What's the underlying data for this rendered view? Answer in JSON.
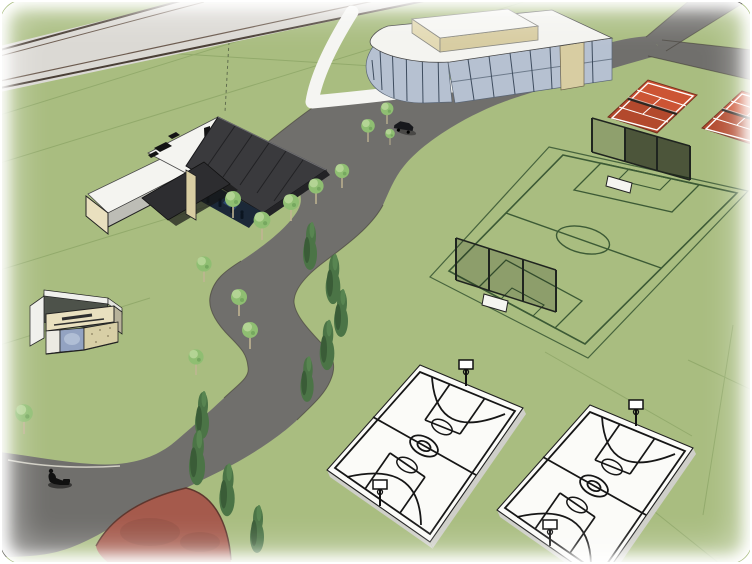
{
  "scene": {
    "title": "Aerial 3D rendering of a sports park master plan",
    "style": "SketchUp-style architectural render, oblique aerial view",
    "ground": "green lawn with faint parcel lines"
  },
  "colors": {
    "grass": "#a9bd80",
    "parcel": "#7d9858",
    "road": "#706f6c",
    "road_edge": "#45413b",
    "road_light": "#dbd9d4",
    "road_light_stripe": "#4a3f36",
    "road_light_stripe2": "#6b5a4e",
    "sidewalk": "#f5f5f2",
    "track_red": "#a55a4c",
    "track_edge": "#5e372e",
    "tennis_red": "#cc5434",
    "tennis_edge": "#7a3322",
    "net_dark": "#2e2620",
    "field_line": "#3c5a35",
    "fence": "#1f241f",
    "slab": "#fbfbf8",
    "slab_side": "#cfcfc9",
    "court_line": "#161616",
    "roof_white": "#f4f4f0",
    "roof_dark": "#3a3a3d",
    "glass_dark": "#1b2838",
    "glass_light": "#b6c1d1",
    "mullion": "#3e4c5e",
    "tan": "#d8cda2",
    "cream": "#e9e0bf",
    "kiosk_blue": "#93a3c2",
    "kiosk_speckle": "#d8cfa6",
    "tree_light": "#8fbe72",
    "tree_light_hi": "#bad89a",
    "trunk": "#c0b592",
    "tree_dark": "#4b7446",
    "tree_dark_shade": "#3a5c37",
    "figure": "#101010"
  },
  "facilities": {
    "clubhouse": {
      "label": "Clubhouse with dark pitched roof, glass front and white flat-roofed wing"
    },
    "glass_pavilion": {
      "label": "Glass pavilion with rounded corner and raised rooftop volume"
    },
    "kiosk": {
      "label": "Small kiosk with banner sign",
      "banner_text_legible": false
    },
    "tennis_courts": {
      "label": "Red tennis courts",
      "count": 2
    },
    "soccer_field": {
      "label": "Fenced soccer field with goal backstops",
      "count": 1
    },
    "basketball_courts": {
      "label": "White basketball courts",
      "count": 2
    },
    "track_plaza": {
      "label": "Red circular surface, partially visible at bottom left",
      "count": 1
    },
    "roads": {
      "label": "Gray access roads with junction and winding park path"
    },
    "sidewalk": {
      "label": "White sidewalk wrapping the glass pavilion"
    },
    "trees": {
      "round_trees": 13,
      "conifers": 9
    },
    "person": {
      "label": "Pedestrian silhouette on the lower road",
      "count": 1
    },
    "vehicle": {
      "label": "Small dark vehicle parked by the road",
      "count": 1
    }
  }
}
